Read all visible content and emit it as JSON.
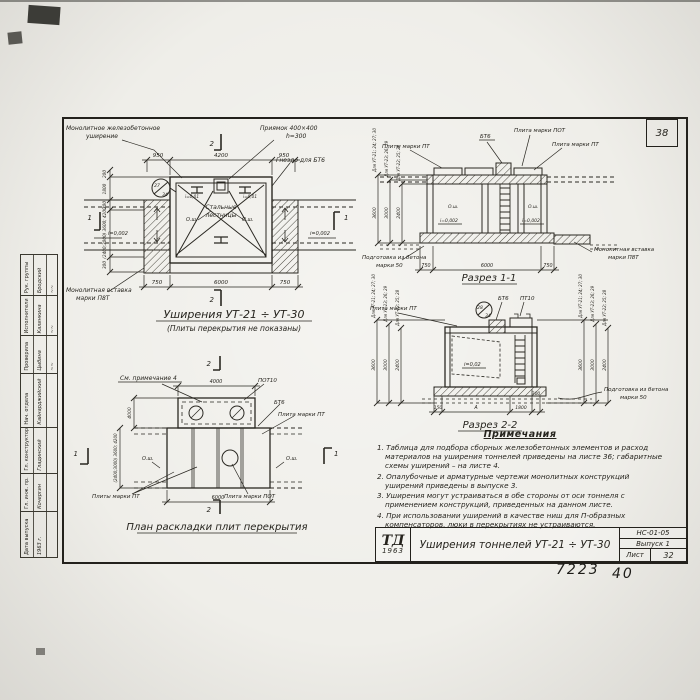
{
  "sheet": {
    "corner_number": "38",
    "code": "НС-01-05",
    "issue": "Выпуск 1",
    "sheet_label": "Лист",
    "sheet_number": "32",
    "logo": "ТД",
    "logo_year": "1963",
    "title": "Уширения тоннелей УТ-21 ÷ УТ-30",
    "hand_number": "7223",
    "hand_number2": "40"
  },
  "stamp": {
    "cells": [
      {
        "role": "Дата выпуска",
        "name": "1963 г.",
        "sig": ""
      },
      {
        "role": "Гл. инж. пр.",
        "name": "Кочергин",
        "sig": ""
      },
      {
        "role": "Гл. конструктор",
        "name": "Гладинский",
        "sig": ""
      },
      {
        "role": "Нач. отдела",
        "name": "Кайнарджийский",
        "sig": ""
      },
      {
        "role": "Проверила",
        "name": "Цыбина",
        "sig": "~~"
      },
      {
        "role": "Исполнители",
        "name": "Калинкина",
        "sig": "~~"
      },
      {
        "role": "Рук. группы",
        "name": "Бродский",
        "sig": "~~"
      }
    ]
  },
  "d1": {
    "title": "Уширения УТ-21 ÷ УТ-30",
    "subtitle": "(Плиты перекрытия не показаны)",
    "lbl_mono1": "Монолитное железобетонное",
    "lbl_mono2": "уширение",
    "lbl_pit1": "Приямок 400×400",
    "lbl_pit2": "h=300",
    "lbl_socket": "Гнездо для БТ6",
    "lbl_stairs1": "Стальные",
    "lbl_stairs2": "лестницы",
    "lbl_insert1": "Монолитная вставка",
    "lbl_insert2": "марки П8Т",
    "mark_top": "27",
    "mark_bot": "34",
    "slope_small_l": "i=0,01",
    "slope_small_r": "i=0,01",
    "slope_l": "i=0,002",
    "slope_r": "i=0,002",
    "osh_l": "О.ш.",
    "osh_r": "О.ш.",
    "sec1": "1",
    "sec2": "2",
    "dim_top": [
      "950",
      "4200",
      "950"
    ],
    "dim_bot": [
      "750",
      "6000",
      "750"
    ],
    "dim_side": [
      "200",
      "1800",
      "200",
      "(2400;3000) 3600; 4200",
      "300"
    ]
  },
  "s1": {
    "caption": "Разрез 1-1",
    "lbl_bt6": "БТ6",
    "lbl_pot": "Плита марки ПОТ",
    "lbl_pt_l": "Плиты марки ПТ",
    "lbl_pt_r": "Плита марки ПТ",
    "lbl_prep1": "Подготовка из бетона",
    "lbl_prep2": "марки 50",
    "lbl_ins1": "Монолитная вставка",
    "lbl_ins2": "марки П8Т",
    "slope_l": "i=0,002",
    "slope_r": "i=0,002",
    "osh_l": "О.ш.",
    "osh_r": "О.ш.",
    "dim_bot": [
      "750",
      "6000",
      "750"
    ],
    "vdims": [
      {
        "label": "Для УТ-21; 24; 27; 30",
        "value": "3600"
      },
      {
        "label": "Для УТ-23; 26; 29",
        "value": "3000"
      },
      {
        "label": "Для УТ-22; 25; 28",
        "value": "2400"
      }
    ]
  },
  "s2": {
    "caption": "Разрез 2-2",
    "lbl_pt": "Плита марки ПТ",
    "lbl_bt6": "БТ6",
    "lbl_pt10": "ПТ10",
    "slope": "i=0,02",
    "lbl_prep1": "Подготовка из бетона",
    "lbl_prep2": "марки 50",
    "mark_top": "28",
    "mark_bot": "34",
    "dim_bot": [
      "150",
      "А",
      "1800",
      "300"
    ],
    "vdims": [
      {
        "label": "Для УТ-21; 24; 27; 30",
        "value": "3600"
      },
      {
        "label": "Для УТ-23; 26; 29",
        "value": "3000"
      },
      {
        "label": "Для УТ-22; 25; 28",
        "value": "2400"
      }
    ]
  },
  "plan": {
    "caption": "План раскладки плит перекрытия",
    "note_ref": "См. примечание 4",
    "lbl_pot10": "ПОТ10",
    "lbl_bt6": "БТ6",
    "lbl_pt_r": "Плита марки ПТ",
    "lbl_pt_b": "Плиты марки ПТ",
    "lbl_pot_b": "Плита марки ПОТ",
    "osh_l": "О.ш.",
    "osh_r": "О.ш.",
    "sec1": "1",
    "sec2": "2",
    "dim_top": "4000",
    "dim_bot": "6000",
    "vdim_top": "4000",
    "vdim_main": "(2400;3000) 3600; 4200"
  },
  "notes": {
    "title": "Примечания",
    "items": [
      "1. Таблица для подбора сборных железобетонных элементов и расход материалов на уширения тоннелей приведены на листе 36; габаритные схемы уширений – на листе 4.",
      "2. Опалубочные и арматурные чертежи монолитных конструкций уширений приведены в выпуске 3.",
      "3. Уширения могут устраиваться в обе стороны от оси тоннеля с применением конструкций, приведенных на данном листе.",
      "4. При использовании уширений в качестве ниш для П-образных компенсаторов, люки в перекрытиях не устраиваются."
    ]
  }
}
